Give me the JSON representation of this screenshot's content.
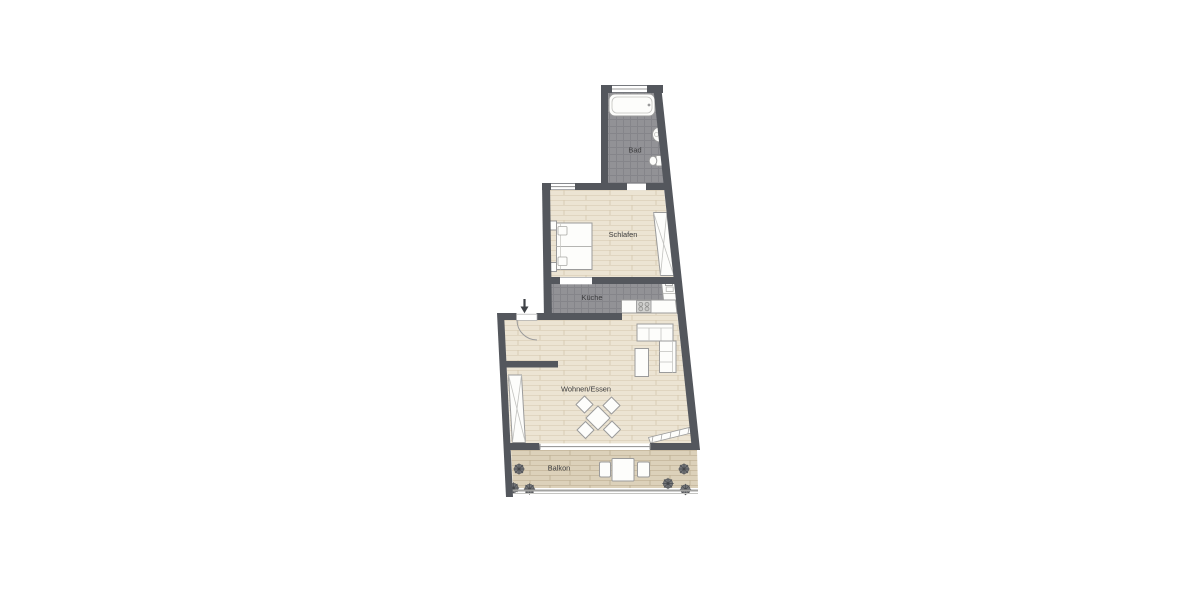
{
  "plan": {
    "type": "floor-plan",
    "rooms": [
      {
        "id": "bad",
        "label": "Bad",
        "floor": "tile",
        "furniture": [
          "bathtub-icon",
          "washbasin-icon",
          "toilet-icon",
          "window-icon"
        ]
      },
      {
        "id": "schlafen",
        "label": "Schlafen",
        "floor": "wood",
        "furniture": [
          "double-bed-icon",
          "nightstand-icon",
          "nightstand-icon",
          "wardrobe-icon",
          "window-icon"
        ]
      },
      {
        "id": "kueche",
        "label": "Küche",
        "floor": "tile",
        "furniture": [
          "kitchen-counter-icon",
          "stove-icon",
          "kitchen-sink-icon"
        ]
      },
      {
        "id": "wohnen_essen",
        "label": "Wohnen/Essen",
        "floor": "wood",
        "furniture": [
          "entrance-arrow-icon",
          "entrance-door-icon",
          "corner-sofa-icon",
          "coffee-table-icon",
          "dining-table-icon",
          "dining-chair-icon",
          "dining-chair-icon",
          "dining-chair-icon",
          "dining-chair-icon",
          "wardrobe-icon",
          "radiator-icon",
          "balcony-window-icon"
        ]
      },
      {
        "id": "balkon",
        "label": "Balkon",
        "floor": "deck",
        "furniture": [
          "balcony-table-icon",
          "balcony-chair-icon",
          "balcony-chair-icon",
          "plant-icon",
          "plant-icon",
          "plant-icon",
          "plant-icon",
          "plant-icon",
          "plant-icon",
          "railing-icon"
        ]
      }
    ],
    "colors": {
      "background": "#ffffff",
      "wall": "#54575d",
      "tile_floor": "#929296",
      "tile_grout": "#85858a",
      "wood_floor": "#ece4d3",
      "wood_grain": "#dcd0b9",
      "deck_floor": "#dcd1ba",
      "deck_grain": "#c7ba9e",
      "furniture_fill": "#fdfdfb",
      "furniture_stroke": "#9b9b9b",
      "label_text": "#3c3c3e"
    }
  }
}
